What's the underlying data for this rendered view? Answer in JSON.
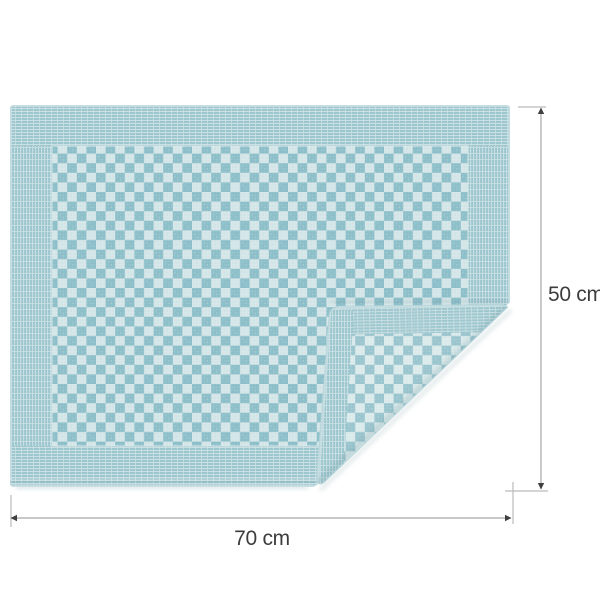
{
  "page": {
    "background": "#ffffff",
    "description": "Product dimension diagram: blue checkered kitchen tea towel with folded bottom-right corner"
  },
  "towel": {
    "pattern": "checkerboard",
    "front_check_dark": "#8ec0ca",
    "front_check_light": "#d6e7e9",
    "back_check_dark": "#9cc6cf",
    "back_check_light": "#dcebec",
    "border_base": "#9ec7cf",
    "border_stripe_light": "#c8dfe3",
    "hem_color": "#c6dee2"
  },
  "dimensions": {
    "height_label": "50 cm",
    "width_label": "70 cm",
    "line_color": "#a6a6a6",
    "tick_color": "#bbbbbb",
    "arrow_color": "#404040",
    "text_color": "#3d3d3d"
  }
}
